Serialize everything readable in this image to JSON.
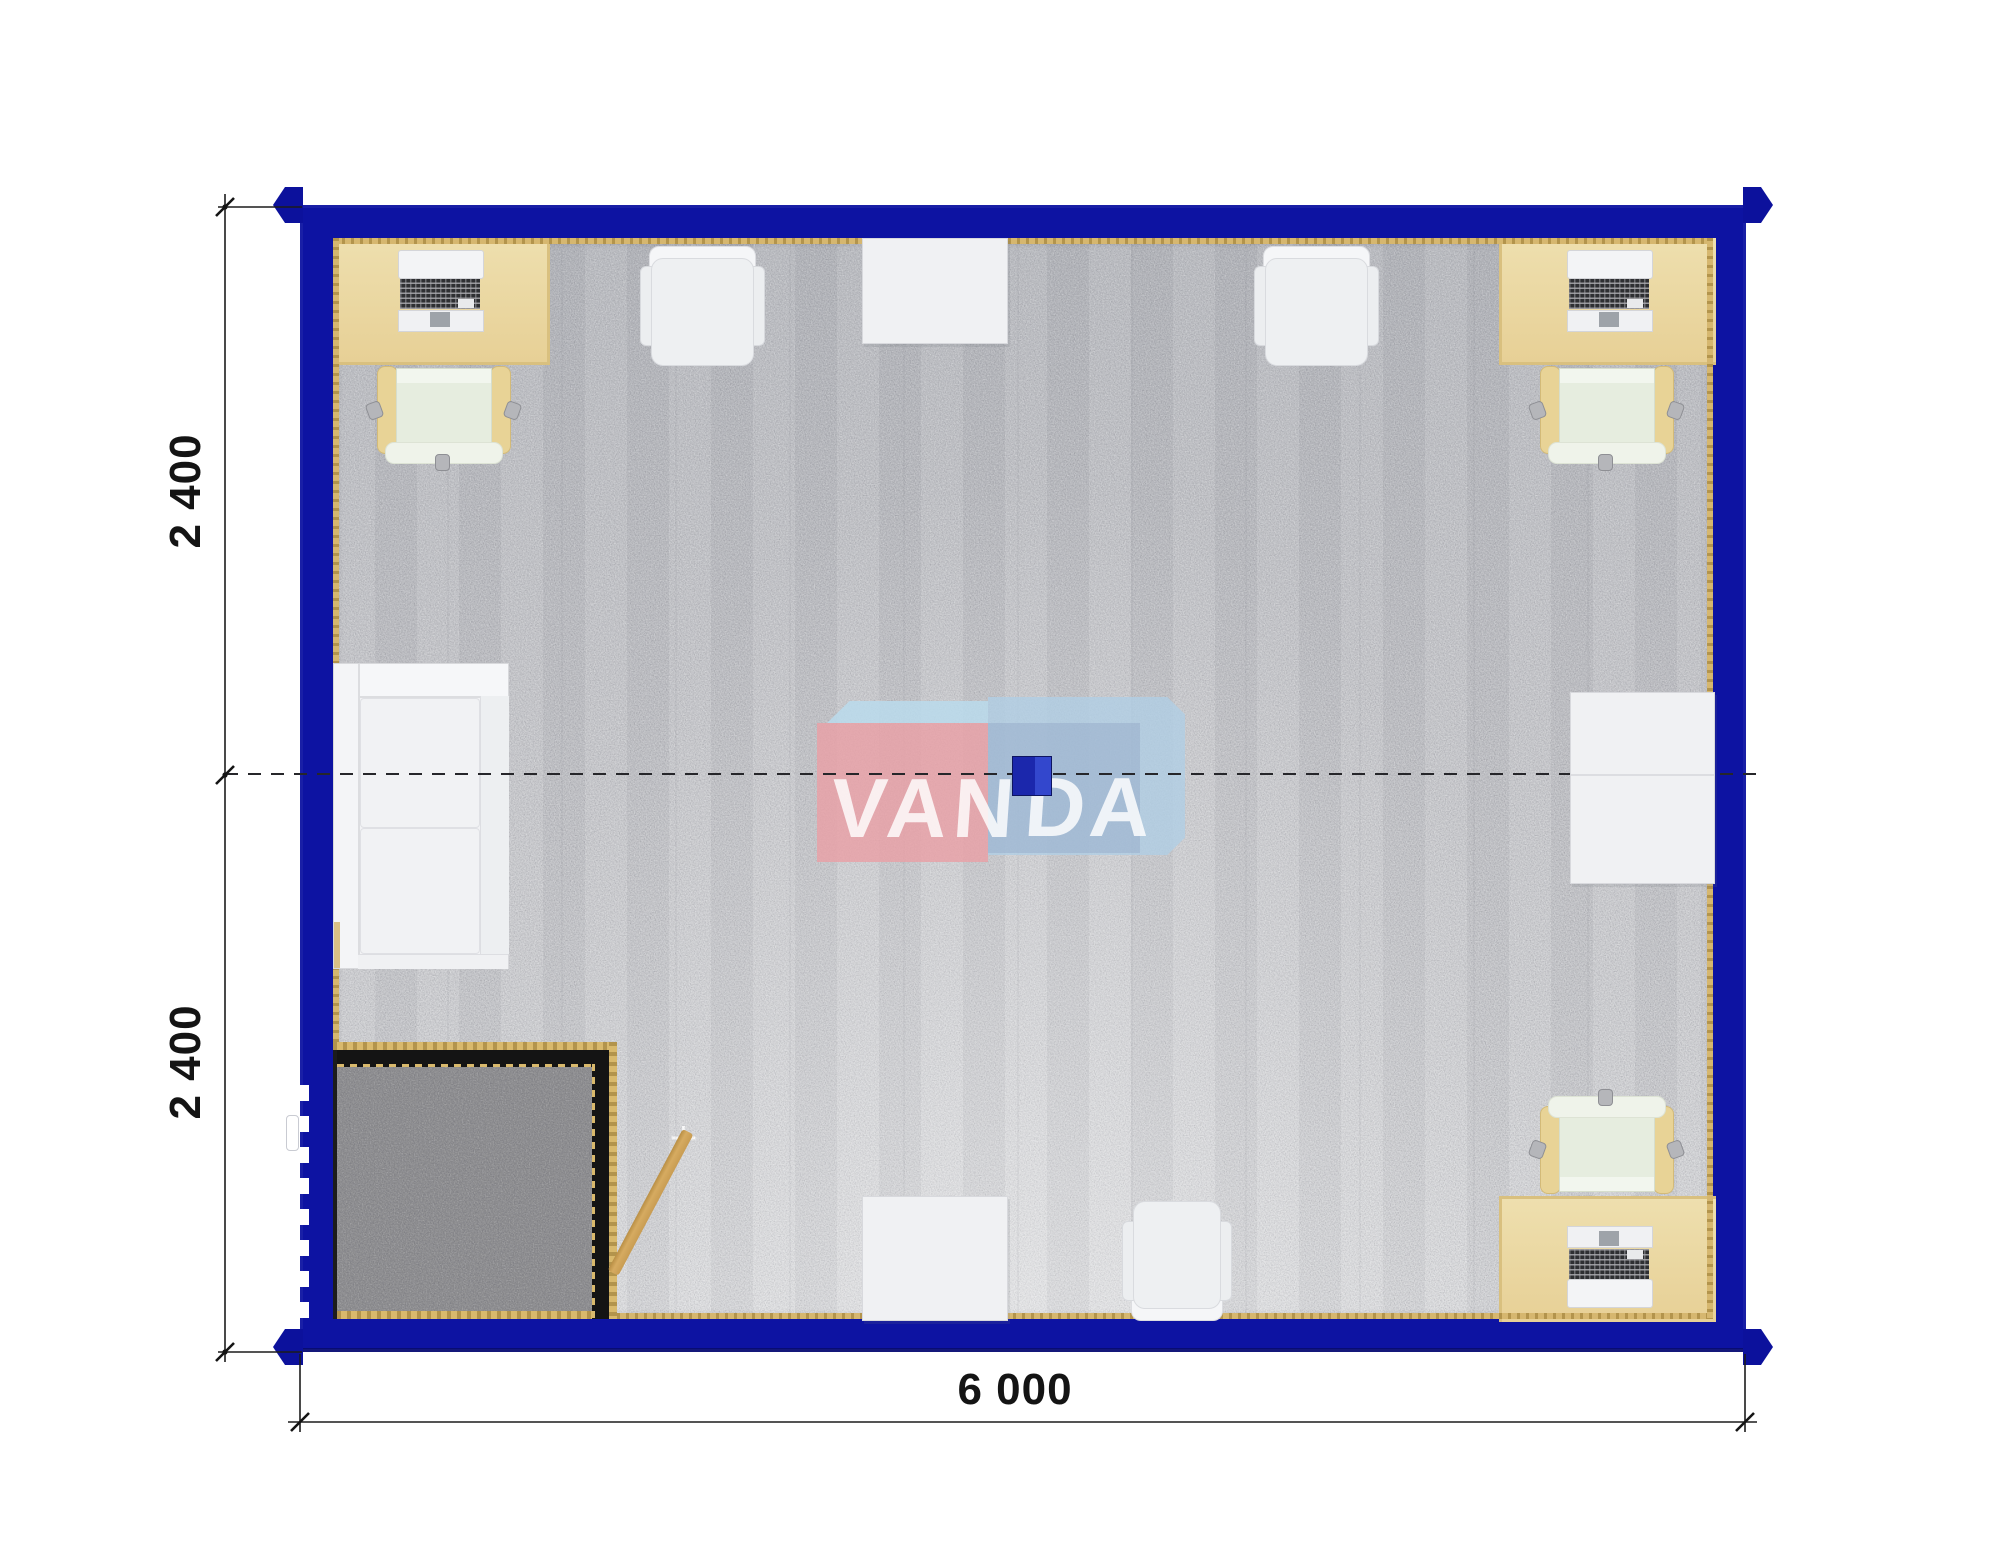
{
  "watermark": {
    "text_left": "VAN",
    "text_right": "DA"
  },
  "dimensions": {
    "module_top_label": "2 400",
    "module_bottom_label": "2 400",
    "width_label": "6 000"
  },
  "floorplan": {
    "type": "modular-container-office-top-view",
    "modules": [
      {
        "label": "2 400"
      },
      {
        "label": "2 400"
      }
    ],
    "overall_width_label": "6 000",
    "furniture": [
      {
        "item": "desk-with-laptop",
        "count": 3
      },
      {
        "item": "office-swivel-chair",
        "count": 3
      },
      {
        "item": "visitor-chair",
        "count": 3
      },
      {
        "item": "side-table",
        "count": 3
      },
      {
        "item": "corner-sofa",
        "count": 1
      },
      {
        "item": "entry-mat",
        "count": 1
      },
      {
        "item": "entry-door",
        "count": 1
      },
      {
        "item": "ceiling-lamp",
        "count": 1
      }
    ]
  },
  "palette": {
    "wall_blue": "#0d13a2",
    "carpet_gray": "#c5c6ca",
    "mat_dark_gray": "#8d8d8f",
    "desk_tan": "#ead7a0",
    "floor_trim_gold": "#c9ab62",
    "logo_pink": "#e9a3a9",
    "logo_light_blue": "#b5d0e6",
    "logo_square_blue": "#2433b4",
    "dimension_text": "#141414"
  }
}
